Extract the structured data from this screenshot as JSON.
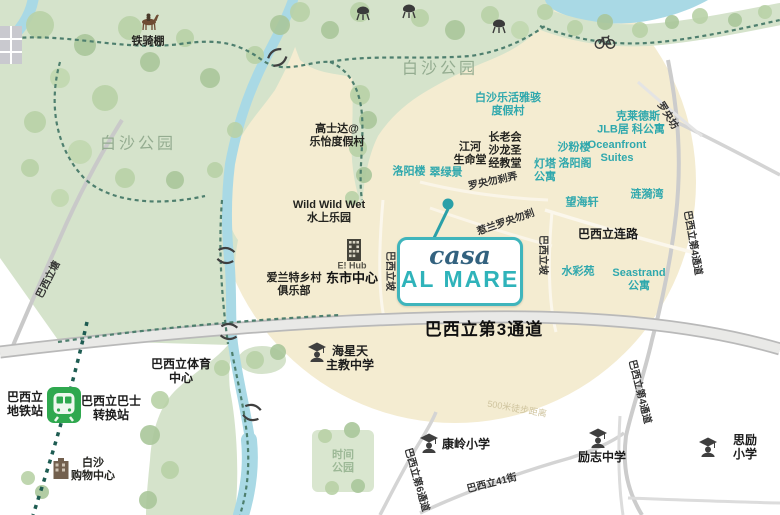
{
  "map": {
    "logo": {
      "script": "casa",
      "main": "AL MARE"
    },
    "radius_circle": {
      "center_x": 455,
      "center_y": 182,
      "radius": 241,
      "note": "500米徒步距离"
    },
    "colors": {
      "background": "#ffffff",
      "circle": "#f4ecd1",
      "park": "#d5e3cb",
      "tree": "#b9d2a7",
      "water": "#a9d9e5",
      "road": "#c9c9c9",
      "connector": "#4e7f6e",
      "mrt_line": "#1e5c52",
      "mrt_green": "#2fa84f",
      "teal_text": "#2fa8ad",
      "park_text": "#94ac90",
      "logo_teal": "#2fb3ba",
      "logo_navy": "#33627f"
    },
    "labels": [
      {
        "name": "label-iron-rider-shed",
        "text": "铁骑棚",
        "x": 148,
        "y": 42,
        "style": "black-sm"
      },
      {
        "name": "label-costa-sands-resort",
        "text": "高士达@\n乐怡度假村",
        "x": 337,
        "y": 136,
        "style": "black-sm"
      },
      {
        "name": "label-pasir-ris-park-west",
        "text": "白沙公园",
        "x": 138,
        "y": 145,
        "style": "park"
      },
      {
        "name": "label-pasir-ris-park-center",
        "text": "白沙公园",
        "x": 440,
        "y": 70,
        "style": "park"
      },
      {
        "name": "label-lohas-resort",
        "text": "白沙乐活雅骇\n度假村",
        "x": 508,
        "y": 105,
        "style": "teal"
      },
      {
        "name": "label-river-life-church",
        "text": "江河\n生命堂",
        "x": 470,
        "y": 154,
        "style": "black-sm"
      },
      {
        "name": "label-presbyterian-church",
        "text": "长老会\n沙龙圣\n经教堂",
        "x": 505,
        "y": 151,
        "style": "black-sm"
      },
      {
        "name": "label-luo-yang-lou",
        "text": "洛阳楼",
        "x": 409,
        "y": 172,
        "style": "teal"
      },
      {
        "name": "label-cui-lv-jing",
        "text": "翠绿景",
        "x": 446,
        "y": 173,
        "style": "teal"
      },
      {
        "name": "label-lighthouse-apt",
        "text": "灯塔\n公寓",
        "x": 545,
        "y": 171,
        "style": "teal"
      },
      {
        "name": "label-sha-fen-lou",
        "text": "沙粉楼",
        "x": 574,
        "y": 148,
        "style": "teal"
      },
      {
        "name": "label-luo-yang-ge",
        "text": "洛阳阁",
        "x": 575,
        "y": 164,
        "style": "teal"
      },
      {
        "name": "label-ke-lai-de-si",
        "text": "克莱德斯",
        "x": 638,
        "y": 117,
        "style": "teal"
      },
      {
        "name": "label-jlb-residence",
        "text": "JLB居  科公寓",
        "x": 631,
        "y": 130,
        "style": "teal"
      },
      {
        "name": "label-oceanfront-suites",
        "text": "Oceanfront\nSuites",
        "x": 617,
        "y": 152,
        "style": "teal"
      },
      {
        "name": "label-ripple-bay",
        "text": "涟漪湾",
        "x": 647,
        "y": 195,
        "style": "teal"
      },
      {
        "name": "label-sea-esta",
        "text": "望海轩",
        "x": 582,
        "y": 203,
        "style": "teal"
      },
      {
        "name": "label-watercolours",
        "text": "水彩苑",
        "x": 578,
        "y": 272,
        "style": "teal"
      },
      {
        "name": "label-seastrand",
        "text": "Seastrand\n公寓",
        "x": 639,
        "y": 280,
        "style": "teal"
      },
      {
        "name": "label-wild-wild-wet",
        "text": "Wild Wild Wet\n水上乐园",
        "x": 329,
        "y": 212,
        "style": "black-sm"
      },
      {
        "name": "label-aranda-country-club",
        "text": "爱兰特乡村\n俱乐部",
        "x": 294,
        "y": 285,
        "style": "black-sm"
      },
      {
        "name": "label-ehub",
        "text": "E! Hub",
        "x": 352,
        "y": 266,
        "style": "gray-xs"
      },
      {
        "name": "label-downtown-east",
        "text": "东市中心",
        "x": 352,
        "y": 278,
        "style": "black-md"
      },
      {
        "name": "label-lorong-loyang-besar",
        "text": "罗央勿刹弄",
        "x": 493,
        "y": 182,
        "rotate": -12,
        "style": "road"
      },
      {
        "name": "label-jalan-loyang-besar",
        "text": "惹兰罗央勿刹",
        "x": 506,
        "y": 223,
        "rotate": -19,
        "style": "road"
      },
      {
        "name": "label-loyang-fang",
        "text": "罗央坊",
        "x": 667,
        "y": 116,
        "rotate": 58,
        "style": "road"
      },
      {
        "name": "label-pasir-ris-dr4-upper",
        "text": "巴西立第4通道",
        "x": 692,
        "y": 243,
        "rotate": 80,
        "style": "road"
      },
      {
        "name": "label-pasir-ris-dr4-lower",
        "text": "巴西立第4通道",
        "x": 639,
        "y": 392,
        "rotate": 76,
        "style": "road"
      },
      {
        "name": "label-pasir-ris-rise-west",
        "text": "巴西立坡",
        "x": 389,
        "y": 271,
        "rotate": 90,
        "style": "road"
      },
      {
        "name": "label-pasir-ris-rise-east",
        "text": "巴西立坡",
        "x": 542,
        "y": 255,
        "rotate": 90,
        "style": "road"
      },
      {
        "name": "label-pasir-ris-tang",
        "text": "巴西立塘",
        "x": 49,
        "y": 280,
        "rotate": -63,
        "style": "road"
      },
      {
        "name": "label-pasir-ris-dr3",
        "text": "巴西立第3通道",
        "x": 484,
        "y": 330,
        "style": "black-lg"
      },
      {
        "name": "label-pasir-ris-link",
        "text": "巴西立连路",
        "x": 608,
        "y": 234,
        "style": "black-md2"
      },
      {
        "name": "label-hai-sing-catholic",
        "text": "海星天\n主教中学",
        "x": 350,
        "y": 358,
        "style": "black-md2"
      },
      {
        "name": "label-sports-centre",
        "text": "巴西立体育\n中心",
        "x": 181,
        "y": 371,
        "style": "black-md2"
      },
      {
        "name": "label-mrt-station",
        "text": "巴西立\n地铁站",
        "x": 25,
        "y": 404,
        "style": "black-md2"
      },
      {
        "name": "label-bus-interchange",
        "text": "巴西立巴士\n转换站",
        "x": 111,
        "y": 408,
        "style": "black-md2"
      },
      {
        "name": "label-white-sands-mall",
        "text": "白沙\n购物中心",
        "x": 93,
        "y": 470,
        "style": "black-sm"
      },
      {
        "name": "label-time-park",
        "text": "时间\n公园",
        "x": 343,
        "y": 462,
        "style": "park-sm"
      },
      {
        "name": "label-radius-note",
        "text": "500米徒步距离",
        "x": 517,
        "y": 409,
        "rotate": 10,
        "style": "faint"
      },
      {
        "name": "label-kang-ling-primary",
        "text": "康岭小学",
        "x": 466,
        "y": 444,
        "style": "black-md2"
      },
      {
        "name": "label-li-zhi-secondary",
        "text": "励志中学",
        "x": 602,
        "y": 457,
        "style": "black-md2"
      },
      {
        "name": "label-si-li-primary",
        "text": "思励小学",
        "x": 745,
        "y": 447,
        "style": "black-md2"
      },
      {
        "name": "label-pasir-ris-st41",
        "text": "巴西立41街",
        "x": 492,
        "y": 484,
        "rotate": -14,
        "style": "road"
      },
      {
        "name": "label-pasir-ris-dr6",
        "text": "巴西立第6通道",
        "x": 416,
        "y": 480,
        "rotate": 74,
        "style": "road"
      }
    ],
    "icons": [
      {
        "name": "horse-icon",
        "type": "horse",
        "x": 149,
        "y": 22
      },
      {
        "name": "bbq-grill-icon",
        "type": "grill",
        "x": 363,
        "y": 13
      },
      {
        "name": "bbq-grill-icon",
        "type": "grill",
        "x": 409,
        "y": 11
      },
      {
        "name": "bbq-grill-icon",
        "type": "grill",
        "x": 499,
        "y": 26
      },
      {
        "name": "bicycle-icon",
        "type": "bicycle",
        "x": 605,
        "y": 41
      },
      {
        "name": "bridge-icon",
        "type": "bridge",
        "x": 277,
        "y": 57,
        "rotate": -35
      },
      {
        "name": "bridge-icon",
        "type": "bridge",
        "x": 226,
        "y": 255,
        "rotate": 8
      },
      {
        "name": "bridge-icon",
        "type": "bridge",
        "x": 229,
        "y": 331,
        "rotate": 5
      },
      {
        "name": "bridge-icon",
        "type": "bridge",
        "x": 252,
        "y": 412,
        "rotate": 15
      },
      {
        "name": "school-icon",
        "type": "school",
        "x": 317,
        "y": 352
      },
      {
        "name": "school-icon",
        "type": "school",
        "x": 429,
        "y": 443
      },
      {
        "name": "school-icon",
        "type": "school",
        "x": 598,
        "y": 438
      },
      {
        "name": "school-icon",
        "type": "school",
        "x": 708,
        "y": 447
      },
      {
        "name": "mrt-station-icon",
        "type": "mrt",
        "x": 64,
        "y": 405
      },
      {
        "name": "ehub-building-icon",
        "type": "building-dark",
        "x": 354,
        "y": 250
      },
      {
        "name": "mall-building-icon",
        "type": "building-brown",
        "x": 61,
        "y": 470
      }
    ]
  }
}
